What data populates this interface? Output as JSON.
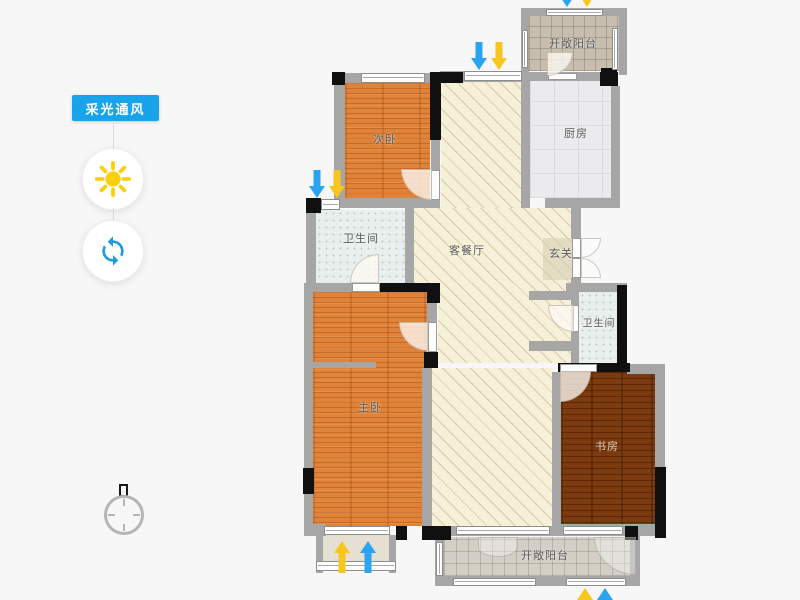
{
  "panel": {
    "title": "采光通风"
  },
  "rooms": {
    "secondary_bedroom": "次卧",
    "kitchen": "厨房",
    "balcony_top": "开敞阳台",
    "bathroom_upper": "卫生间",
    "living_dining": "客餐厅",
    "entry": "玄关",
    "bathroom_lower": "卫生间",
    "master_bedroom": "主卧",
    "study": "书房",
    "balcony_bottom": "开敞阳台"
  },
  "icons": {
    "sun": "sun-icon",
    "refresh": "refresh-icon",
    "compass": "compass-icon",
    "light_arrow": "light-arrow-icon",
    "wind_arrow": "wind-arrow-icon"
  },
  "colors": {
    "panel_blue": "#18a4ea",
    "sun_yellow": "#fccf0d",
    "refresh_blue": "#1e9ce2",
    "light_arrow_yellow": "#f7c71d",
    "wind_arrow_blue": "#2aa4f0",
    "wall_gray": "#a6a6a6",
    "wall_black": "#101010",
    "background": "#f7f7f7"
  }
}
